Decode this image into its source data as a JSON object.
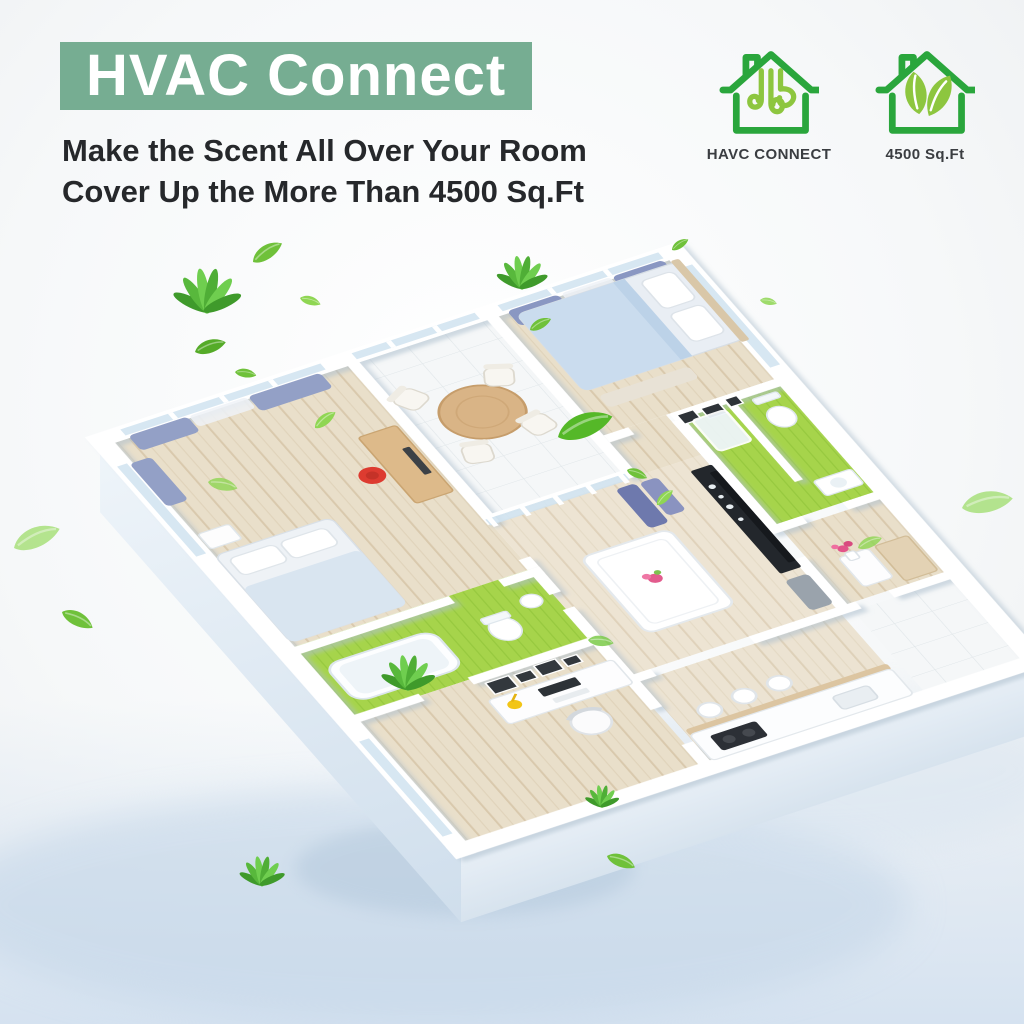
{
  "header": {
    "title": "HVAC Connect",
    "subtitle_line1": "Make the Scent All Over Your Room",
    "subtitle_line2": "Cover Up the More Than 4500 Sq.Ft"
  },
  "badges": [
    {
      "icon": "hvac-connect-house-icon",
      "label": "HAVC CONNECT"
    },
    {
      "icon": "leaf-house-icon",
      "label": "4500 Sq.Ft"
    }
  ],
  "colors": {
    "banner_green": "#76ad92",
    "title_text": "#ffffff",
    "subtitle_text": "#26282b",
    "icon_outline_green": "#2aa63c",
    "icon_inner_green": "#8dc63f",
    "leaf_green": "#62bb35",
    "bath_floor_green": "#a6d44b",
    "wood_floor": "#e9dfca",
    "curtain_blue": "#8a93c0",
    "shadow_blue": "#c3d6e7"
  }
}
